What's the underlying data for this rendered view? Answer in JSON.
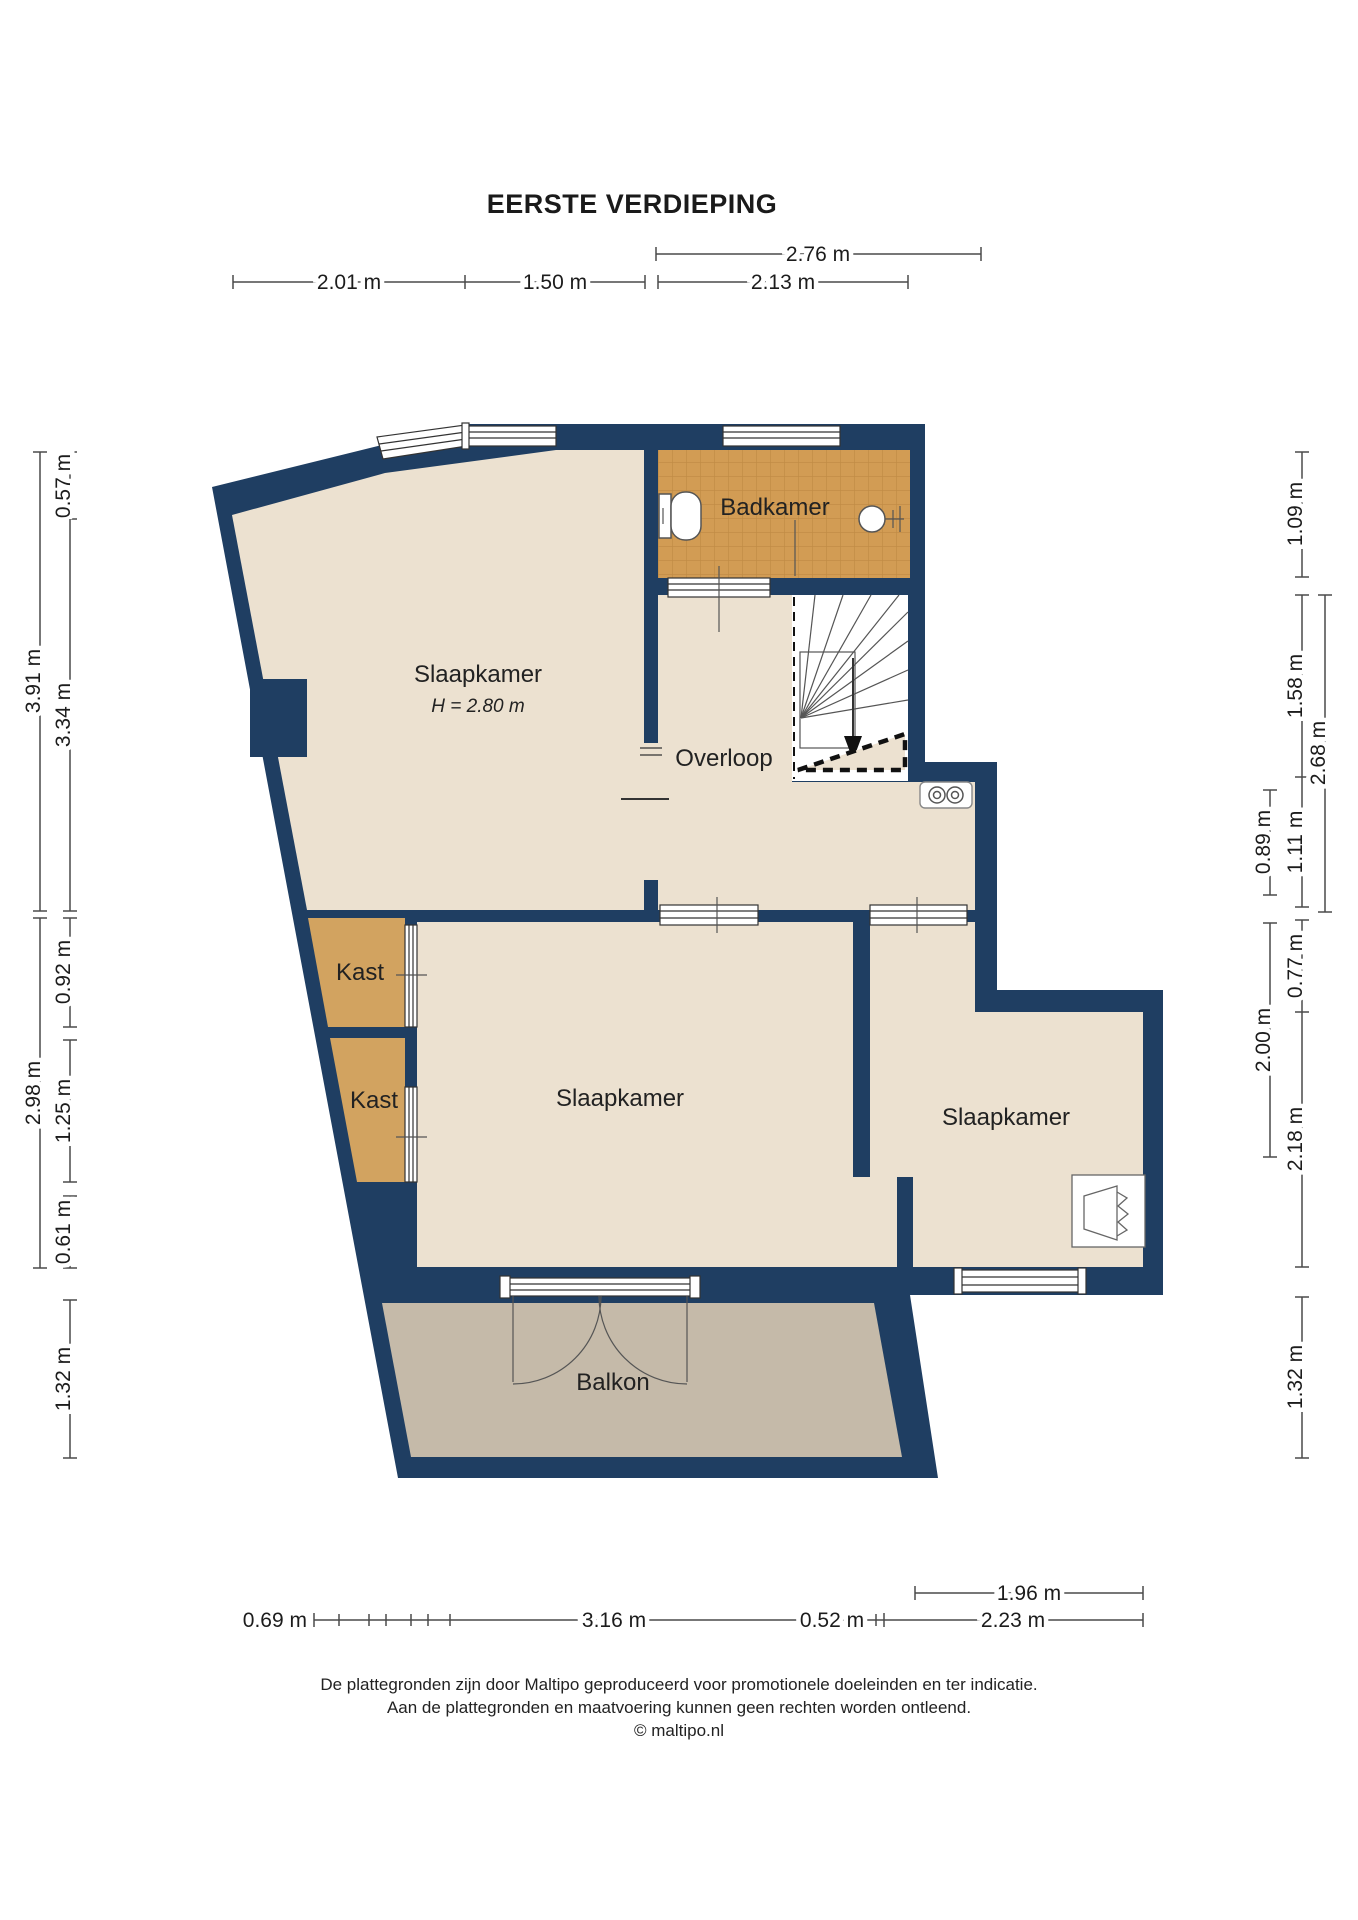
{
  "title": "EERSTE VERDIEPING",
  "rooms": {
    "slaapkamer_tl": {
      "name": "Slaapkamer",
      "height_note": "H = 2.80 m"
    },
    "badkamer": {
      "name": "Badkamer"
    },
    "overloop": {
      "name": "Overloop"
    },
    "kast1": {
      "name": "Kast"
    },
    "kast2": {
      "name": "Kast"
    },
    "slaapkamer_mid": {
      "name": "Slaapkamer"
    },
    "slaapkamer_right": {
      "name": "Slaapkamer"
    },
    "balkon": {
      "name": "Balkon"
    }
  },
  "dimensions": {
    "top": [
      {
        "label": "2.76 m"
      },
      {
        "label": "2.01 m"
      },
      {
        "label": "1.50 m"
      },
      {
        "label": "2.13 m"
      }
    ],
    "left": [
      {
        "label": "0.57 m"
      },
      {
        "label": "3.91 m"
      },
      {
        "label": "3.34 m"
      },
      {
        "label": "0.92 m"
      },
      {
        "label": "2.98 m"
      },
      {
        "label": "1.25 m"
      },
      {
        "label": "0.61 m"
      },
      {
        "label": "1.32 m"
      }
    ],
    "right": [
      {
        "label": "1.09 m"
      },
      {
        "label": "1.58 m"
      },
      {
        "label": "2.68 m"
      },
      {
        "label": "0.89 m"
      },
      {
        "label": "1.11 m"
      },
      {
        "label": "0.77 m"
      },
      {
        "label": "2.00 m"
      },
      {
        "label": "2.18 m"
      },
      {
        "label": "1.32 m"
      }
    ],
    "bottom": [
      {
        "label": "1.96 m"
      },
      {
        "label": "0.69 m"
      },
      {
        "label": "3.16 m"
      },
      {
        "label": "0.52 m"
      },
      {
        "label": "2.23 m"
      }
    ]
  },
  "footer": {
    "line1": "De plattegronden zijn door Maltipo geproduceerd voor promotionele doeleinden en ter indicatie.",
    "line2": "Aan de plattegronden en maatvoering kunnen geen rechten worden ontleend.",
    "line3": "© maltipo.nl"
  },
  "colors": {
    "wall": "#1f3e62",
    "floor": "#ece1d0",
    "bathroom_tile": "#d29c54",
    "closet": "#d2a360",
    "balcony": "#c5baa9"
  }
}
